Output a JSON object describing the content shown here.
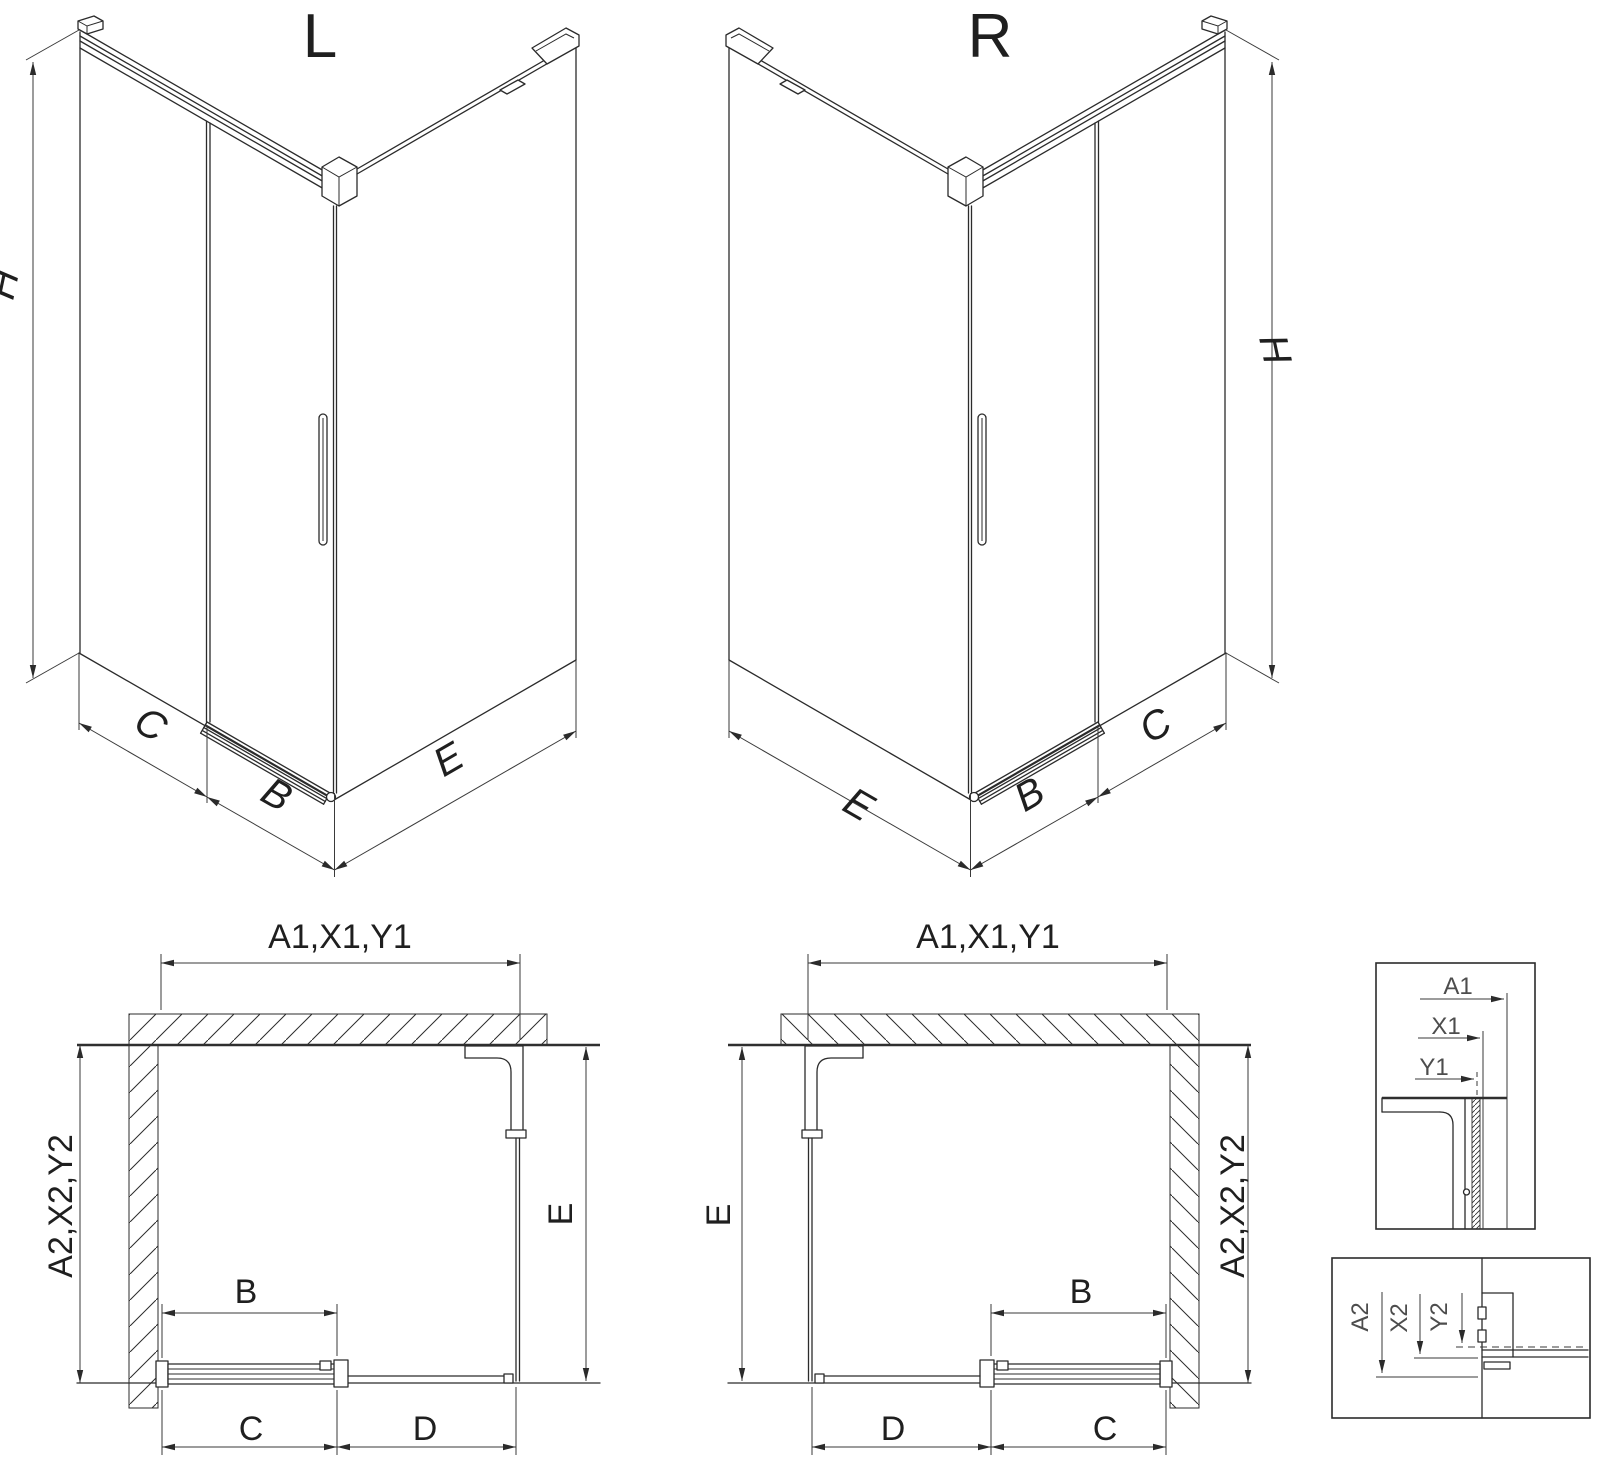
{
  "drawing": {
    "iso_left": {
      "title": "L",
      "dim_h": "H",
      "dim_c": "C",
      "dim_b": "B",
      "dim_e": "E"
    },
    "iso_right": {
      "title": "R",
      "dim_h": "H",
      "dim_c": "C",
      "dim_b": "B",
      "dim_e": "E"
    },
    "plan_left": {
      "dim_top": "A1,X1,Y1",
      "dim_left": "A2,X2,Y2",
      "dim_b": "B",
      "dim_c": "C",
      "dim_d": "D",
      "dim_e": "E"
    },
    "plan_right": {
      "dim_top": "A1,X1,Y1",
      "dim_right": "A2,X2,Y2",
      "dim_b": "B",
      "dim_c": "C",
      "dim_d": "D",
      "dim_e": "E"
    },
    "detail_top": {
      "dim_a1": "A1",
      "dim_x1": "X1",
      "dim_y1": "Y1"
    },
    "detail_bottom": {
      "dim_a2": "A2",
      "dim_x2": "X2",
      "dim_y2": "Y2"
    }
  },
  "colors": {
    "line": "#2b2b2b",
    "dimension_line": "#3a3a3a",
    "detail_label": "#4d4d4d",
    "background": "#ffffff"
  }
}
